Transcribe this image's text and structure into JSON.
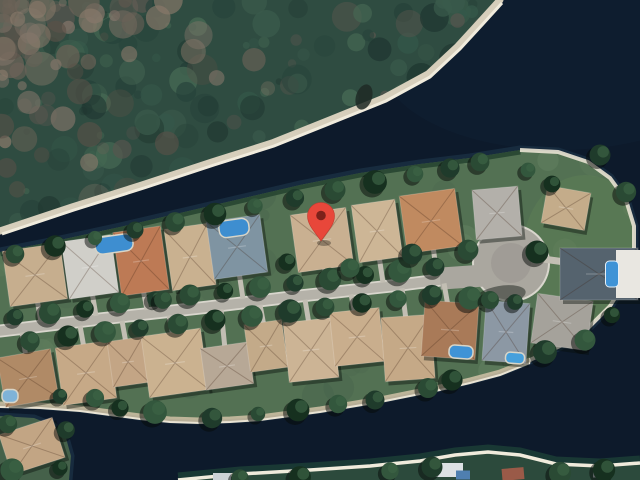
{
  "map": {
    "kind": "satellite-imagery",
    "marker": {
      "x": 321,
      "y": 241,
      "color": "#e8473a",
      "dot_color": "#7c211a"
    },
    "palette": {
      "water": "#0d1a2b",
      "water_halo": "#182e40",
      "water_shallow_teal": "#1d4037",
      "forest_base": "#2f4c41",
      "forest_texture": [
        "#26423a",
        "#3a5a4b",
        "#1f3630",
        "#476a54",
        "#57554e",
        "#35584a"
      ],
      "forest_brown": [
        "#6d6358",
        "#83756a",
        "#5a5148",
        "#8a7a6b"
      ],
      "beach": "#d6cebb",
      "beach_highlight": "#f0ebdc",
      "grass": "#537153",
      "grass_texture": [
        "#5e7e5c",
        "#45624a",
        "#6b8a66",
        "#4a684e"
      ],
      "grass_tip_patch": "#5c7e55",
      "street": "#b5b2a9",
      "street_edge": "#d9d6cd",
      "culdesac": "#aaa79f",
      "driveway": "#c2beb3",
      "sand_south": "#c9bda1",
      "sand_white": "#e9e3d3",
      "mangrove": "#24422f",
      "tree_greens": [
        "#1f3b2b",
        "#2a4a34",
        "#16301f",
        "#33573d"
      ],
      "tree_shadow": "rgba(6,10,8,0.5)",
      "house_shadow": "rgba(8,14,10,0.42)",
      "pool_default": "#3f93d6"
    },
    "forest": {
      "outline": [
        [
          0,
          0
        ],
        [
          500,
          0
        ],
        [
          480,
          22
        ],
        [
          458,
          46
        ],
        [
          428,
          74
        ],
        [
          384,
          98
        ],
        [
          332,
          119
        ],
        [
          272,
          143
        ],
        [
          212,
          162
        ],
        [
          142,
          185
        ],
        [
          72,
          207
        ],
        [
          0,
          231
        ]
      ],
      "beach_edge": [
        [
          500,
          0
        ],
        [
          480,
          22
        ],
        [
          458,
          46
        ],
        [
          428,
          74
        ],
        [
          384,
          98
        ],
        [
          332,
          119
        ],
        [
          272,
          143
        ],
        [
          212,
          162
        ],
        [
          142,
          185
        ],
        [
          72,
          207
        ],
        [
          0,
          231
        ]
      ],
      "beach_dark_spot": {
        "x": 364,
        "y": 97,
        "rx": 8,
        "ry": 13
      }
    },
    "peninsula": {
      "outline": [
        [
          0,
          252
        ],
        [
          60,
          240
        ],
        [
          120,
          227
        ],
        [
          180,
          213
        ],
        [
          240,
          199
        ],
        [
          300,
          185
        ],
        [
          360,
          173
        ],
        [
          420,
          164
        ],
        [
          470,
          158
        ],
        [
          520,
          150
        ],
        [
          558,
          152
        ],
        [
          588,
          162
        ],
        [
          610,
          178
        ],
        [
          626,
          200
        ],
        [
          634,
          226
        ],
        [
          634,
          252
        ],
        [
          626,
          280
        ],
        [
          610,
          306
        ],
        [
          588,
          328
        ],
        [
          560,
          346
        ],
        [
          530,
          360
        ],
        [
          500,
          372
        ],
        [
          470,
          380
        ],
        [
          440,
          387
        ],
        [
          410,
          393
        ],
        [
          380,
          399
        ],
        [
          350,
          404
        ],
        [
          320,
          409
        ],
        [
          290,
          413
        ],
        [
          260,
          417
        ],
        [
          230,
          419
        ],
        [
          200,
          420
        ],
        [
          170,
          419
        ],
        [
          140,
          416
        ],
        [
          110,
          412
        ],
        [
          80,
          408
        ],
        [
          40,
          405
        ],
        [
          0,
          404
        ]
      ],
      "north_shore": [
        [
          0,
          252
        ],
        [
          60,
          240
        ],
        [
          120,
          227
        ],
        [
          180,
          213
        ],
        [
          240,
          199
        ],
        [
          300,
          185
        ],
        [
          360,
          173
        ],
        [
          420,
          164
        ],
        [
          470,
          158
        ],
        [
          520,
          150
        ]
      ],
      "tip_arc": [
        [
          520,
          150
        ],
        [
          558,
          152
        ],
        [
          588,
          162
        ],
        [
          610,
          178
        ],
        [
          626,
          200
        ],
        [
          634,
          226
        ],
        [
          634,
          252
        ],
        [
          626,
          280
        ],
        [
          610,
          306
        ],
        [
          588,
          328
        ],
        [
          560,
          346
        ],
        [
          530,
          360
        ]
      ],
      "south_shore": [
        [
          530,
          360
        ],
        [
          500,
          372
        ],
        [
          470,
          380
        ],
        [
          440,
          387
        ],
        [
          410,
          393
        ],
        [
          380,
          399
        ],
        [
          350,
          404
        ],
        [
          320,
          409
        ],
        [
          290,
          413
        ],
        [
          260,
          417
        ],
        [
          230,
          419
        ],
        [
          200,
          420
        ],
        [
          170,
          419
        ],
        [
          140,
          416
        ],
        [
          110,
          412
        ],
        [
          80,
          408
        ],
        [
          40,
          405
        ],
        [
          0,
          404
        ]
      ]
    },
    "street": {
      "path": [
        [
          0,
          331
        ],
        [
          100,
          319
        ],
        [
          200,
          308
        ],
        [
          300,
          296
        ],
        [
          400,
          285
        ],
        [
          448,
          279
        ]
      ],
      "width": 9.5,
      "edge_width": 13,
      "culdesac": {
        "cx": 511,
        "cy": 263,
        "r": 37
      },
      "estate_driveway": [
        [
          543,
          259
        ],
        [
          572,
          263
        ]
      ]
    },
    "houses_north": [
      [
        35,
        275,
        58,
        56,
        -8,
        "#c6ae8e"
      ],
      [
        90,
        267,
        50,
        58,
        -8,
        "#d0cfc9"
      ],
      [
        141,
        261,
        48,
        64,
        -8,
        "#bd7a55"
      ],
      [
        190,
        257,
        44,
        62,
        -8,
        "#c9b190"
      ],
      [
        237,
        247,
        54,
        58,
        -8,
        "#7f94a2"
      ],
      [
        322,
        240,
        56,
        58,
        -8,
        "#c9b091"
      ],
      [
        377,
        231,
        44,
        58,
        -8,
        "#cdb696"
      ],
      [
        431,
        221,
        56,
        58,
        -8,
        "#c08a60"
      ],
      [
        497,
        213,
        46,
        50,
        -5,
        "#b3b0aa"
      ],
      [
        566,
        208,
        44,
        38,
        10,
        "#c4ac8a"
      ]
    ],
    "houses_south": [
      [
        28,
        378,
        54,
        50,
        -10,
        "#b08a66"
      ],
      [
        86,
        373,
        54,
        58,
        -8,
        "#c6a987"
      ],
      [
        128,
        362,
        36,
        46,
        -8,
        "#c3a585"
      ],
      [
        175,
        363,
        60,
        62,
        -8,
        "#cbb290"
      ],
      [
        227,
        366,
        48,
        42,
        -8,
        "#b7a896"
      ],
      [
        266,
        346,
        38,
        48,
        -8,
        "#c3aa89"
      ],
      [
        311,
        350,
        50,
        60,
        -6,
        "#ccb495"
      ],
      [
        357,
        337,
        50,
        54,
        -6,
        "#c9ae8d"
      ],
      [
        408,
        348,
        50,
        64,
        -4,
        "#c5a987"
      ],
      [
        450,
        330,
        54,
        56,
        4,
        "#a97a58"
      ],
      [
        506,
        332,
        44,
        60,
        4,
        "#8c98a4"
      ],
      [
        562,
        322,
        56,
        50,
        8,
        "#a5a29b"
      ]
    ],
    "estate": {
      "roof": [
        599,
        274,
        78,
        52,
        0,
        "#55636e"
      ],
      "wing": [
        628,
        274,
        24,
        48,
        0,
        "#e9e7e1"
      ],
      "pool": [
        612,
        274,
        13,
        26,
        0,
        "#3f93d6"
      ]
    },
    "pools": [
      [
        114,
        244,
        38,
        17,
        -8,
        "#3e8ed0"
      ],
      [
        234,
        228,
        30,
        17,
        -8,
        "#3e8ed0"
      ],
      [
        10,
        396,
        16,
        13,
        0,
        "#7fb3d8"
      ],
      [
        461,
        352,
        24,
        13,
        4,
        "#3f93d6"
      ],
      [
        515,
        358,
        19,
        11,
        4,
        "#46a0dc"
      ]
    ],
    "bottom_left_island": {
      "outline": [
        [
          0,
          416
        ],
        [
          34,
          418
        ],
        [
          54,
          426
        ],
        [
          66,
          438
        ],
        [
          71,
          456
        ],
        [
          69,
          480
        ],
        [
          0,
          480
        ]
      ],
      "house": [
        32,
        446,
        56,
        42,
        -18,
        "#c2a584"
      ]
    },
    "bottom_strip": {
      "outline": [
        [
          178,
          480
        ],
        [
          240,
          474
        ],
        [
          310,
          470
        ],
        [
          370,
          466
        ],
        [
          420,
          461
        ],
        [
          455,
          455
        ],
        [
          488,
          452
        ],
        [
          520,
          455
        ],
        [
          556,
          464
        ],
        [
          600,
          466
        ],
        [
          640,
          463
        ],
        [
          640,
          480
        ]
      ],
      "beach_edge": [
        [
          178,
          480
        ],
        [
          240,
          474
        ],
        [
          310,
          470
        ],
        [
          370,
          466
        ],
        [
          420,
          461
        ],
        [
          455,
          455
        ],
        [
          488,
          452
        ],
        [
          520,
          455
        ],
        [
          556,
          464
        ],
        [
          600,
          466
        ],
        [
          640,
          463
        ]
      ],
      "buildings": [
        [
          448,
          470,
          30,
          14,
          0,
          "#dde1e4"
        ],
        [
          463,
          475,
          14,
          9,
          0,
          "#4f7fb0"
        ],
        [
          513,
          474,
          22,
          12,
          -5,
          "#9a5a48"
        ],
        [
          222,
          477,
          18,
          8,
          0,
          "#ccd2d6"
        ],
        [
          601,
          473,
          16,
          9,
          0,
          "#b9bfc4"
        ]
      ]
    },
    "trees": [
      [
        15,
        317
      ],
      [
        50,
        313
      ],
      [
        85,
        309
      ],
      [
        120,
        303
      ],
      [
        155,
        299
      ],
      [
        190,
        295
      ],
      [
        225,
        291
      ],
      [
        260,
        287
      ],
      [
        295,
        283
      ],
      [
        330,
        279
      ],
      [
        365,
        275
      ],
      [
        400,
        271
      ],
      [
        435,
        267
      ],
      [
        30,
        341
      ],
      [
        68,
        336
      ],
      [
        105,
        332
      ],
      [
        140,
        328
      ],
      [
        178,
        324
      ],
      [
        215,
        320
      ],
      [
        252,
        316
      ],
      [
        290,
        311
      ],
      [
        325,
        307
      ],
      [
        362,
        303
      ],
      [
        398,
        299
      ],
      [
        432,
        295
      ],
      [
        15,
        254
      ],
      [
        55,
        246
      ],
      [
        95,
        238
      ],
      [
        135,
        230
      ],
      [
        175,
        222
      ],
      [
        215,
        214
      ],
      [
        255,
        206
      ],
      [
        295,
        198
      ],
      [
        335,
        190
      ],
      [
        375,
        182
      ],
      [
        415,
        174
      ],
      [
        450,
        168
      ],
      [
        480,
        162
      ],
      [
        120,
        408
      ],
      [
        155,
        412
      ],
      [
        212,
        418
      ],
      [
        258,
        414
      ],
      [
        298,
        410
      ],
      [
        338,
        404
      ],
      [
        375,
        400
      ],
      [
        428,
        388
      ],
      [
        452,
        380
      ],
      [
        95,
        398
      ],
      [
        60,
        396
      ],
      [
        163,
        300
      ],
      [
        287,
        262
      ],
      [
        350,
        268
      ],
      [
        412,
        254
      ],
      [
        468,
        250
      ],
      [
        537,
        252
      ],
      [
        470,
        298
      ],
      [
        515,
        302
      ],
      [
        490,
        300
      ],
      [
        552,
        184
      ],
      [
        528,
        170
      ],
      [
        600,
        155
      ],
      [
        626,
        192
      ],
      [
        612,
        315
      ],
      [
        585,
        340
      ],
      [
        545,
        352
      ],
      [
        8,
        424
      ],
      [
        60,
        468
      ],
      [
        12,
        470
      ],
      [
        66,
        430
      ],
      [
        240,
        478
      ],
      [
        300,
        477
      ],
      [
        390,
        471
      ],
      [
        432,
        467
      ],
      [
        560,
        473
      ],
      [
        604,
        470
      ]
    ]
  }
}
